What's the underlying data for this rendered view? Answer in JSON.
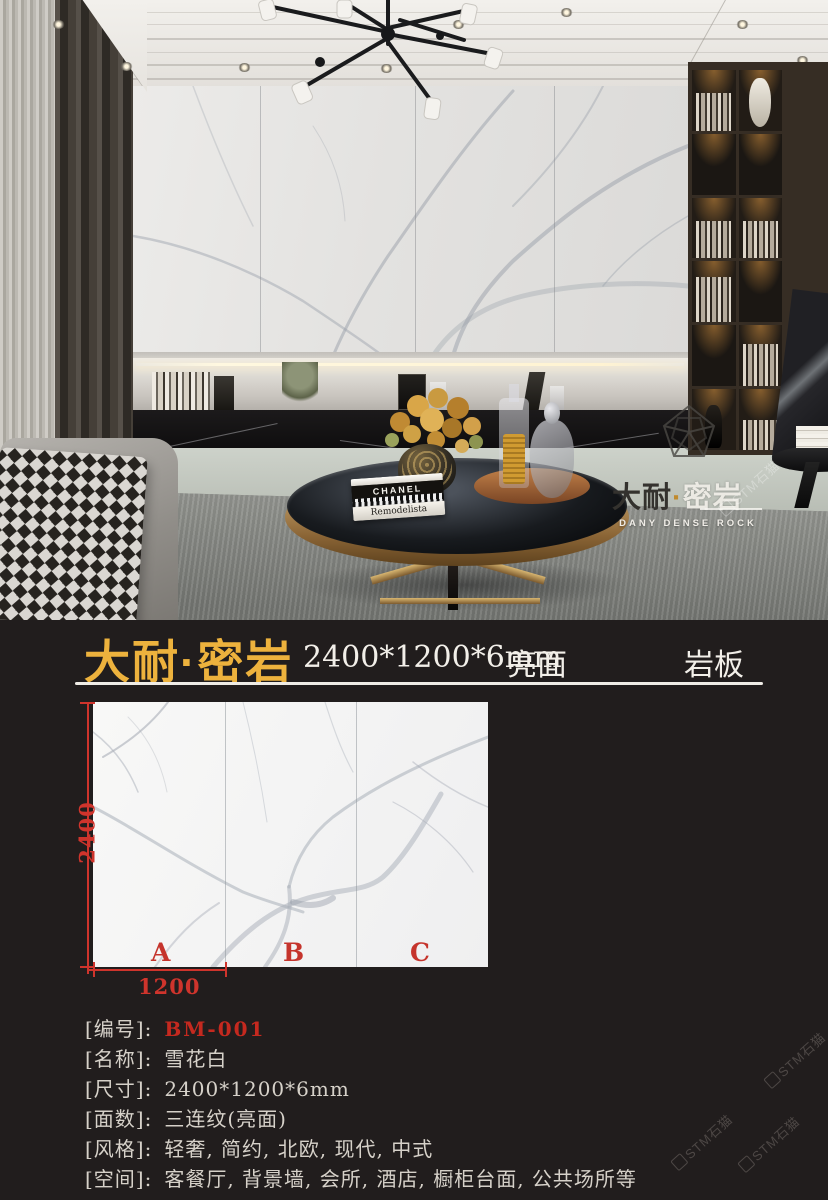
{
  "header": {
    "brand": "大耐·密岩",
    "size": "2400*1200*6mm",
    "finish": "亮面",
    "product": "岩板"
  },
  "photo": {
    "logo_dark": "大耐",
    "logo_dot": "·",
    "logo_light": "密岩",
    "logo_en": "DANY DENSE ROCK",
    "book_top": "CHANEL",
    "book_bottom": "Remodelista"
  },
  "figure": {
    "height_label": "2400",
    "width_label": "1200",
    "panel_labels": [
      "A",
      "B",
      "C"
    ]
  },
  "specs": {
    "rows": [
      {
        "label": "[编号]:",
        "value": "BM-001",
        "highlight": true
      },
      {
        "label": "[名称]:",
        "value": "雪花白",
        "highlight": false
      },
      {
        "label": "[尺寸]:",
        "value": "2400*1200*6mm",
        "highlight": false
      },
      {
        "label": "[面数]:",
        "value": "三连纹(亮面)",
        "highlight": false
      },
      {
        "label": "[风格]:",
        "value": "轻奢, 简约, 北欧, 现代, 中式",
        "highlight": false
      },
      {
        "label": "[空间]:",
        "value": "客餐厅, 背景墙, 会所, 酒店, 橱柜台面, 公共场所等",
        "highlight": false
      }
    ]
  },
  "watermark": {
    "text": "STM石猫"
  },
  "colors": {
    "accent_gold": "#edb23d",
    "accent_red": "#cf342c",
    "background": "#211d1d"
  }
}
